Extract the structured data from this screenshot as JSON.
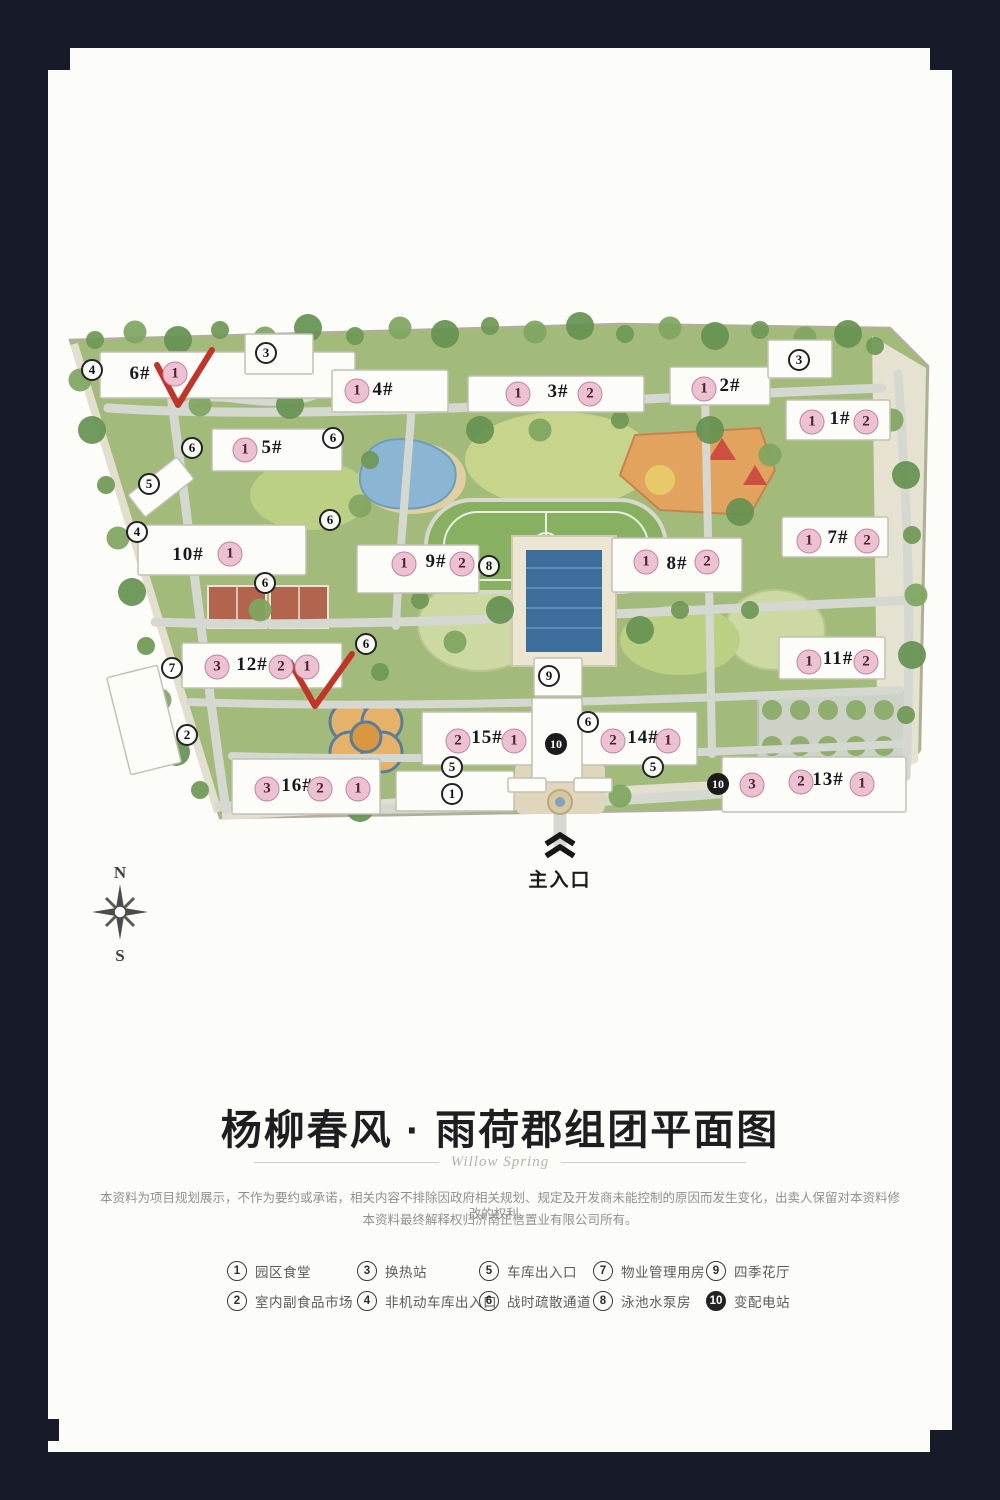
{
  "title_block": {
    "heading": "杨柳春风 · 雨荷郡组团平面图",
    "signature": "Willow Spring"
  },
  "disclaimer": {
    "line1": "本资料为项目规划展示，不作为要约或承诺，相关内容不排除因政府相关规划、规定及开发商未能控制的原因而发生变化，出卖人保留对本资料修改的权利。",
    "line2": "本资料最终解释权归济南正信置业有限公司所有。"
  },
  "legend": {
    "items": [
      {
        "n": "1",
        "label": "园区食堂",
        "solid": false
      },
      {
        "n": "2",
        "label": "室内副食品市场",
        "solid": false
      },
      {
        "n": "3",
        "label": "换热站",
        "solid": false
      },
      {
        "n": "4",
        "label": "非机动车库出入口",
        "solid": false
      },
      {
        "n": "5",
        "label": "车库出入口",
        "solid": false
      },
      {
        "n": "6",
        "label": "战时疏散通道",
        "solid": false
      },
      {
        "n": "7",
        "label": "物业管理用房",
        "solid": false
      },
      {
        "n": "8",
        "label": "泳池水泵房",
        "solid": false
      },
      {
        "n": "9",
        "label": "四季花厅",
        "solid": false
      },
      {
        "n": "10",
        "label": "变配电站",
        "solid": true
      }
    ]
  },
  "map": {
    "entrance_label": "主入口",
    "compass": {
      "north": "N",
      "south": "S"
    },
    "building_labels": [
      {
        "t": "6#",
        "x": 80,
        "y": 64
      },
      {
        "t": "4#",
        "x": 323,
        "y": 80
      },
      {
        "t": "3#",
        "x": 498,
        "y": 82
      },
      {
        "t": "2#",
        "x": 670,
        "y": 76
      },
      {
        "t": "1#",
        "x": 780,
        "y": 109
      },
      {
        "t": "5#",
        "x": 212,
        "y": 138
      },
      {
        "t": "10#",
        "x": 128,
        "y": 245
      },
      {
        "t": "9#",
        "x": 376,
        "y": 252
      },
      {
        "t": "8#",
        "x": 617,
        "y": 254
      },
      {
        "t": "7#",
        "x": 778,
        "y": 228
      },
      {
        "t": "12#",
        "x": 192,
        "y": 355
      },
      {
        "t": "11#",
        "x": 778,
        "y": 349
      },
      {
        "t": "15#",
        "x": 427,
        "y": 428
      },
      {
        "t": "14#",
        "x": 583,
        "y": 428
      },
      {
        "t": "16#",
        "x": 237,
        "y": 476
      },
      {
        "t": "13#",
        "x": 768,
        "y": 470
      }
    ],
    "unit_markers": [
      {
        "n": "1",
        "x": 115,
        "y": 64
      },
      {
        "n": "1",
        "x": 297,
        "y": 81
      },
      {
        "n": "1",
        "x": 458,
        "y": 84
      },
      {
        "n": "2",
        "x": 530,
        "y": 84
      },
      {
        "n": "1",
        "x": 644,
        "y": 79
      },
      {
        "n": "1",
        "x": 752,
        "y": 112
      },
      {
        "n": "2",
        "x": 806,
        "y": 112
      },
      {
        "n": "1",
        "x": 185,
        "y": 140
      },
      {
        "n": "1",
        "x": 170,
        "y": 244
      },
      {
        "n": "1",
        "x": 344,
        "y": 254
      },
      {
        "n": "2",
        "x": 402,
        "y": 254
      },
      {
        "n": "1",
        "x": 586,
        "y": 252
      },
      {
        "n": "2",
        "x": 647,
        "y": 252
      },
      {
        "n": "1",
        "x": 749,
        "y": 231
      },
      {
        "n": "2",
        "x": 807,
        "y": 231
      },
      {
        "n": "3",
        "x": 157,
        "y": 357
      },
      {
        "n": "2",
        "x": 221,
        "y": 357
      },
      {
        "n": "1",
        "x": 247,
        "y": 357
      },
      {
        "n": "1",
        "x": 749,
        "y": 352
      },
      {
        "n": "2",
        "x": 806,
        "y": 352
      },
      {
        "n": "2",
        "x": 398,
        "y": 431
      },
      {
        "n": "1",
        "x": 454,
        "y": 431
      },
      {
        "n": "2",
        "x": 553,
        "y": 431
      },
      {
        "n": "1",
        "x": 608,
        "y": 431
      },
      {
        "n": "3",
        "x": 207,
        "y": 479
      },
      {
        "n": "2",
        "x": 260,
        "y": 479
      },
      {
        "n": "1",
        "x": 298,
        "y": 479
      },
      {
        "n": "3",
        "x": 692,
        "y": 475
      },
      {
        "n": "2",
        "x": 741,
        "y": 472
      },
      {
        "n": "1",
        "x": 802,
        "y": 474
      }
    ],
    "facility_markers": [
      {
        "n": "4",
        "x": 32,
        "y": 60,
        "s": false
      },
      {
        "n": "3",
        "x": 206,
        "y": 43,
        "s": false
      },
      {
        "n": "3",
        "x": 739,
        "y": 50,
        "s": false
      },
      {
        "n": "6",
        "x": 132,
        "y": 138,
        "s": false
      },
      {
        "n": "6",
        "x": 273,
        "y": 128,
        "s": false
      },
      {
        "n": "5",
        "x": 89,
        "y": 174,
        "s": false
      },
      {
        "n": "4",
        "x": 77,
        "y": 222,
        "s": false
      },
      {
        "n": "6",
        "x": 270,
        "y": 210,
        "s": false
      },
      {
        "n": "6",
        "x": 205,
        "y": 273,
        "s": false
      },
      {
        "n": "8",
        "x": 429,
        "y": 256,
        "s": false
      },
      {
        "n": "6",
        "x": 306,
        "y": 334,
        "s": false
      },
      {
        "n": "9",
        "x": 489,
        "y": 366,
        "s": false
      },
      {
        "n": "6",
        "x": 528,
        "y": 412,
        "s": false
      },
      {
        "n": "7",
        "x": 112,
        "y": 358,
        "s": false
      },
      {
        "n": "2",
        "x": 127,
        "y": 425,
        "s": false
      },
      {
        "n": "5",
        "x": 392,
        "y": 457,
        "s": false
      },
      {
        "n": "5",
        "x": 593,
        "y": 457,
        "s": false
      },
      {
        "n": "1",
        "x": 392,
        "y": 484,
        "s": false
      },
      {
        "n": "10",
        "x": 496,
        "y": 434,
        "s": true
      },
      {
        "n": "10",
        "x": 658,
        "y": 474,
        "s": true
      }
    ],
    "footprints": [
      [
        40,
        42,
        255,
        46
      ],
      [
        185,
        24,
        68,
        40
      ],
      [
        272,
        60,
        116,
        42
      ],
      [
        408,
        66,
        176,
        36
      ],
      [
        610,
        57,
        100,
        38
      ],
      [
        708,
        30,
        64,
        38
      ],
      [
        726,
        90,
        104,
        40
      ],
      [
        152,
        119,
        130,
        42
      ],
      [
        78,
        215,
        168,
        50
      ],
      [
        297,
        235,
        122,
        48
      ],
      [
        552,
        228,
        130,
        54
      ],
      [
        722,
        207,
        106,
        40
      ],
      [
        122,
        333,
        160,
        45
      ],
      [
        719,
        327,
        106,
        42
      ],
      [
        362,
        402,
        116,
        53
      ],
      [
        517,
        402,
        120,
        53
      ],
      [
        472,
        388,
        50,
        84
      ],
      [
        474,
        348,
        48,
        38
      ],
      [
        172,
        449,
        148,
        55
      ],
      [
        336,
        461,
        118,
        40
      ],
      [
        662,
        447,
        184,
        55
      ],
      [
        70,
        163,
        62,
        28,
        -38
      ],
      [
        58,
        360,
        52,
        100,
        -14
      ],
      [
        448,
        468,
        38,
        14
      ],
      [
        514,
        468,
        38,
        14
      ]
    ]
  }
}
